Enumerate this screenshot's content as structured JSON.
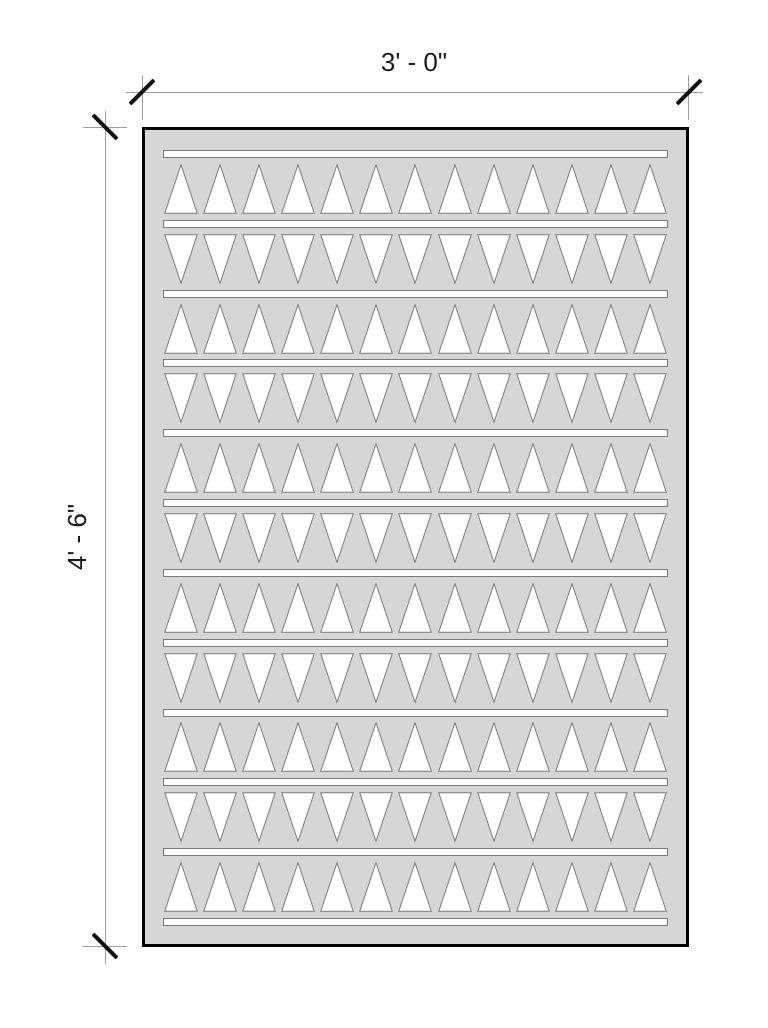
{
  "page": {
    "background_color": "#ffffff"
  },
  "drawing": {
    "type": "panel-elevation",
    "dim_width": {
      "label": "3' - 0\""
    },
    "dim_height": {
      "label": "4' - 6\""
    },
    "colors": {
      "panel_fill": "#d6d6d6",
      "panel_outline": "#000000",
      "cutout_fill": "#ffffff",
      "cutout_stroke": "#7a7a7a",
      "dim_line": "#9e9e9e",
      "tick": "#111111",
      "text": "#1a1a1a"
    },
    "panel": {
      "triangles_per_row": 13,
      "bar_count": 12,
      "rows": [
        {
          "direction": "up"
        },
        {
          "direction": "down"
        },
        {
          "direction": "up"
        },
        {
          "direction": "down"
        },
        {
          "direction": "up"
        },
        {
          "direction": "down"
        },
        {
          "direction": "up"
        },
        {
          "direction": "down"
        },
        {
          "direction": "up"
        },
        {
          "direction": "down"
        },
        {
          "direction": "up"
        }
      ]
    }
  }
}
